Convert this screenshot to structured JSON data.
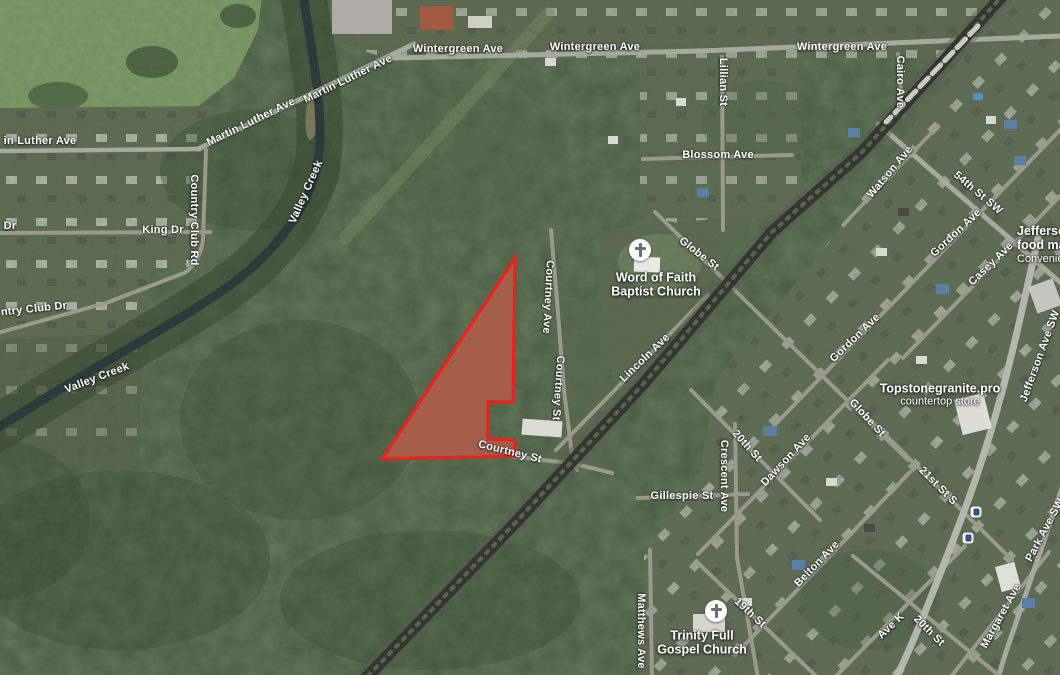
{
  "map": {
    "kind": "satellite-map-with-parcel-overlay",
    "parcel": {
      "ground_fill": "#8d6f58",
      "overlay_fill": "rgba(208,62,45,0.34)",
      "stroke": "#e8231d",
      "stroke_width": 3.2,
      "points": "515,258 513,402 488,402 488,439 514,440 517,456 382,459"
    },
    "street_labels": [
      {
        "id": "wintergreen-ave-1",
        "text": "Wintergreen Ave",
        "x": 458,
        "y": 49,
        "r": 0
      },
      {
        "id": "wintergreen-ave-2",
        "text": "Wintergreen Ave",
        "x": 595,
        "y": 47,
        "r": 0
      },
      {
        "id": "wintergreen-ave-3",
        "text": "Wintergreen Ave",
        "x": 842,
        "y": 47,
        "r": 0
      },
      {
        "id": "martin-luther-ave-1",
        "text": "Martin Luther Ave",
        "x": 251,
        "y": 122,
        "r": -26
      },
      {
        "id": "martin-luther-ave-2",
        "text": "Martin Luther Ave",
        "x": 348,
        "y": 79,
        "r": -26
      },
      {
        "id": "in-luther-ave",
        "text": "in Luther Ave",
        "x": 40,
        "y": 141,
        "r": 0
      },
      {
        "id": "dr-partial",
        "text": "Dr",
        "x": 10,
        "y": 226,
        "r": 0
      },
      {
        "id": "king-dr",
        "text": "King Dr",
        "x": 163,
        "y": 230,
        "r": 0
      },
      {
        "id": "country-club-rd",
        "text": "Country Club Rd",
        "x": 194,
        "y": 220,
        "r": 90
      },
      {
        "id": "ntry-club-dr",
        "text": "ntry Club Dr",
        "x": 34,
        "y": 309,
        "r": -6
      },
      {
        "id": "valley-creek-upper",
        "text": "Valley Creek",
        "x": 306,
        "y": 192,
        "r": -66
      },
      {
        "id": "valley-creek-lower",
        "text": "Valley Creek",
        "x": 97,
        "y": 378,
        "r": -21
      },
      {
        "id": "lillian-st",
        "text": "Lillian St",
        "x": 723,
        "y": 82,
        "r": 90
      },
      {
        "id": "blossom-ave",
        "text": "Blossom Ave",
        "x": 718,
        "y": 155,
        "r": 0
      },
      {
        "id": "globe-st-upper",
        "text": "Globe St",
        "x": 699,
        "y": 254,
        "r": 38
      },
      {
        "id": "lincoln-ave",
        "text": "Lincoln Ave",
        "x": 645,
        "y": 358,
        "r": -44
      },
      {
        "id": "courtney-ave",
        "text": "Courtney Ave",
        "x": 548,
        "y": 297,
        "r": 93
      },
      {
        "id": "courtney-st-vertical",
        "text": "Courtney St",
        "x": 558,
        "y": 388,
        "r": 94
      },
      {
        "id": "courtney-st-diagonal",
        "text": "Courtney St",
        "x": 510,
        "y": 452,
        "r": 14
      },
      {
        "id": "cairo-ave",
        "text": "Cairo Ave",
        "x": 900,
        "y": 82,
        "r": 90
      },
      {
        "id": "watson-ave",
        "text": "Watson Ave",
        "x": 890,
        "y": 172,
        "r": -50
      },
      {
        "id": "54th-st-sw",
        "text": "54th St SW",
        "x": 978,
        "y": 193,
        "r": 40
      },
      {
        "id": "gordon-ave-upper",
        "text": "Gordon Ave",
        "x": 956,
        "y": 233,
        "r": -43
      },
      {
        "id": "casey-ave",
        "text": "Casey Ave",
        "x": 991,
        "y": 264,
        "r": -44
      },
      {
        "id": "gordon-ave-mid",
        "text": "Gordon Ave",
        "x": 855,
        "y": 338,
        "r": -44
      },
      {
        "id": "globe-st-lower",
        "text": "Globe St",
        "x": 867,
        "y": 418,
        "r": 47
      },
      {
        "id": "jefferson-ave-sw",
        "text": "Jefferson Ave SW",
        "x": 1040,
        "y": 356,
        "r": -70
      },
      {
        "id": "21st-st-s",
        "text": "21st St S",
        "x": 938,
        "y": 486,
        "r": 45
      },
      {
        "id": "20th-st-upper",
        "text": "20th St",
        "x": 747,
        "y": 446,
        "r": 48
      },
      {
        "id": "crescent-ave",
        "text": "Crescent Ave",
        "x": 724,
        "y": 476,
        "r": 90
      },
      {
        "id": "dawson-ave",
        "text": "Dawson Ave",
        "x": 786,
        "y": 460,
        "r": -47
      },
      {
        "id": "gillespie-st",
        "text": "Gillespie St",
        "x": 682,
        "y": 496,
        "r": 0
      },
      {
        "id": "19th-st",
        "text": "19th St",
        "x": 750,
        "y": 613,
        "r": 43
      },
      {
        "id": "belton-ave",
        "text": "Belton Ave",
        "x": 817,
        "y": 564,
        "r": -46
      },
      {
        "id": "matthews-ave",
        "text": "Matthews Ave",
        "x": 641,
        "y": 631,
        "r": 90
      },
      {
        "id": "ave-k",
        "text": "Ave K",
        "x": 891,
        "y": 626,
        "r": -44
      },
      {
        "id": "20th-st-lower",
        "text": "20th St",
        "x": 929,
        "y": 631,
        "r": 45
      },
      {
        "id": "margaret-ave",
        "text": "Margaret Ave",
        "x": 1001,
        "y": 616,
        "r": -61
      },
      {
        "id": "park-ave-sw",
        "text": "Park Ave SW",
        "x": 1045,
        "y": 530,
        "r": -62
      }
    ],
    "pois": [
      {
        "id": "word-of-faith-baptist-church",
        "icon": "church",
        "icon_x": 640,
        "icon_y": 250,
        "text_x": 656,
        "text_y": 285,
        "align": "center",
        "lines": [
          {
            "text": "Word of Faith"
          },
          {
            "text": "Baptist Church"
          }
        ]
      },
      {
        "id": "trinity-full-gospel-church",
        "icon": "church",
        "icon_x": 716,
        "icon_y": 611,
        "text_x": 702,
        "text_y": 643,
        "align": "center",
        "lines": [
          {
            "text": "Trinity Full"
          },
          {
            "text": "Gospel Church"
          }
        ]
      },
      {
        "id": "jefferson-food-mart",
        "icon": "store",
        "icon_x": 1038,
        "icon_y": 274,
        "text_x": 1017,
        "text_y": 224,
        "align": "left",
        "lines": [
          {
            "text": "Jefferson"
          },
          {
            "text": "food mart"
          },
          {
            "text": "Convenience",
            "sub": true
          }
        ]
      },
      {
        "id": "topstonegranite-pro",
        "icon": "store",
        "icon_x": 1002,
        "icon_y": 393,
        "text_x": 940,
        "text_y": 395,
        "align": "center",
        "lines": [
          {
            "text": "Topstonegranite.pro"
          },
          {
            "text": "countertop store",
            "sub": true
          }
        ]
      },
      {
        "id": "transit-stop-1",
        "icon": "transit",
        "icon_x": 976,
        "icon_y": 512
      },
      {
        "id": "transit-stop-2",
        "icon": "transit",
        "icon_x": 968,
        "icon_y": 538
      }
    ],
    "paths": [
      {
        "id": "creek-corridor",
        "d": "M303,-6 C310,40 319,85 320,128 C321,168 310,198 288,228 C264,261 236,283 196,308 C148,338 94,368 52,394 C28,409 10,420 -6,430",
        "w": 46,
        "c": "#384731",
        "o": 0.55
      },
      {
        "id": "valley-creek-water",
        "d": "M303,-6 C310,40 319,85 320,128 C321,168 310,198 288,228 C264,261 236,283 196,308 C148,338 94,368 52,394 C28,409 10,420 -6,430",
        "w": 9,
        "c": "#2d3a3c"
      },
      {
        "id": "rail-spur-clearing",
        "d": "M345,238 L548,14",
        "w": 13,
        "c": "#77855f",
        "o": 0.5
      },
      {
        "id": "wintergreen-ave-road",
        "d": "M393,58 L700,51 L1060,36",
        "w": 5,
        "c": "#a6a99e"
      },
      {
        "id": "martin-luther-ave-road",
        "d": "M198,149 L414,44",
        "w": 5,
        "c": "#a6a99e"
      },
      {
        "id": "in-luther-ave-road",
        "d": "M-4,151 L200,149",
        "w": 4.5,
        "c": "#a6a99e"
      },
      {
        "id": "king-dr-road",
        "d": "M-4,233 L210,232",
        "w": 4,
        "c": "#9a998b"
      },
      {
        "id": "country-club-rd-road",
        "d": "M206,150 L203,240 Q199,264 184,273",
        "w": 4,
        "c": "#9a998b"
      },
      {
        "id": "country-club-dr-road",
        "d": "M184,273 L106,303 L-6,334",
        "w": 4,
        "c": "#9a998b"
      },
      {
        "id": "lillian-st-road",
        "d": "M722,57 L723,230",
        "w": 4,
        "c": "#9a998b"
      },
      {
        "id": "blossom-ave-road",
        "d": "M643,159 L792,155",
        "w": 4,
        "c": "#9a998b"
      },
      {
        "id": "globe-st-road",
        "d": "M655,212 L908,460",
        "w": 4,
        "c": "#9a998b"
      },
      {
        "id": "lincoln-ave-road",
        "d": "M556,450 L708,295",
        "w": 4,
        "c": "#9a998b"
      },
      {
        "id": "courtney-ave-road",
        "d": "M551,230 L557,300 L564,390 L572,455 L577,470",
        "w": 4,
        "c": "#9a998b"
      },
      {
        "id": "courtney-st-road",
        "d": "M432,446 L575,464 L612,473",
        "w": 4,
        "c": "#9a998b"
      },
      {
        "id": "cairo-ave-road",
        "d": "M898,54 L903,115",
        "w": 4,
        "c": "#9a998b"
      },
      {
        "id": "54th-st-sw-road",
        "d": "M878,124 L1062,284",
        "w": 5,
        "c": "#a6a99e"
      },
      {
        "id": "watson-ave-road",
        "d": "M843,225 L938,126",
        "w": 3.5,
        "c": "#9a998b"
      },
      {
        "id": "gordon-ave-road",
        "d": "M766,434 L1062,128",
        "w": 4,
        "c": "#9a998b"
      },
      {
        "id": "casey-ave-road",
        "d": "M903,358 L1062,194",
        "w": 4,
        "c": "#9a998b"
      },
      {
        "id": "dawson-ave-road",
        "d": "M698,554 L888,360",
        "w": 4,
        "c": "#9a998b"
      },
      {
        "id": "belton-ave-road",
        "d": "M735,655 L910,472",
        "w": 4,
        "c": "#9a998b"
      },
      {
        "id": "ave-k-road",
        "d": "M834,678 L965,546",
        "w": 4,
        "c": "#9a998b"
      },
      {
        "id": "margaret-ave-road",
        "d": "M950,678 L1049,552",
        "w": 4,
        "c": "#9a998b"
      },
      {
        "id": "park-ave-sw-road",
        "d": "M1062,488 L1006,652 L998,678",
        "w": 5,
        "c": "#a6a99e"
      },
      {
        "id": "20th-st-upper-road",
        "d": "M691,390 L820,520",
        "w": 4,
        "c": "#9a998b"
      },
      {
        "id": "crescent-ave-road",
        "d": "M735,424 L737,558 L758,678",
        "w": 4,
        "c": "#9a998b"
      },
      {
        "id": "19th-st-road",
        "d": "M698,563 L818,678",
        "w": 4,
        "c": "#9a998b"
      },
      {
        "id": "21st-st-s-road",
        "d": "M860,410 L1012,560",
        "w": 4,
        "c": "#9a998b"
      },
      {
        "id": "20th-st-lower-road",
        "d": "M853,556 L1002,678",
        "w": 4,
        "c": "#9a998b"
      },
      {
        "id": "gillespie-st-road",
        "d": "M638,498 L748,494",
        "w": 4,
        "c": "#9a998b"
      },
      {
        "id": "matthews-ave-road",
        "d": "M650,550 L652,678",
        "w": 4,
        "c": "#9a998b"
      },
      {
        "id": "jefferson-ave-sw-road",
        "d": "M1038,238 C1018,330 998,424 960,522 C938,580 914,642 896,678",
        "w": 7,
        "c": "#b4b7ae"
      },
      {
        "id": "railroad-ballast",
        "d": "M1004,-6 L862,152 L772,232 L645,382 L518,520 L366,678",
        "w": 20,
        "c": "#585c4f",
        "o": 0.45
      },
      {
        "id": "railroad",
        "d": "M1004,-6 L862,152 L772,232 L645,382 L518,520 L366,678",
        "w": 12,
        "c": "#33372f"
      },
      {
        "id": "railroad-ties",
        "d": "M1004,-6 L862,152 L772,232 L645,382 L518,520 L366,678",
        "w": 4,
        "c": "#5a6157",
        "dash": "3 7"
      },
      {
        "id": "train-cars",
        "d": "M978,26 L886,122",
        "w": 5,
        "c": "#c7cbc3",
        "dash": "12 6"
      }
    ]
  }
}
